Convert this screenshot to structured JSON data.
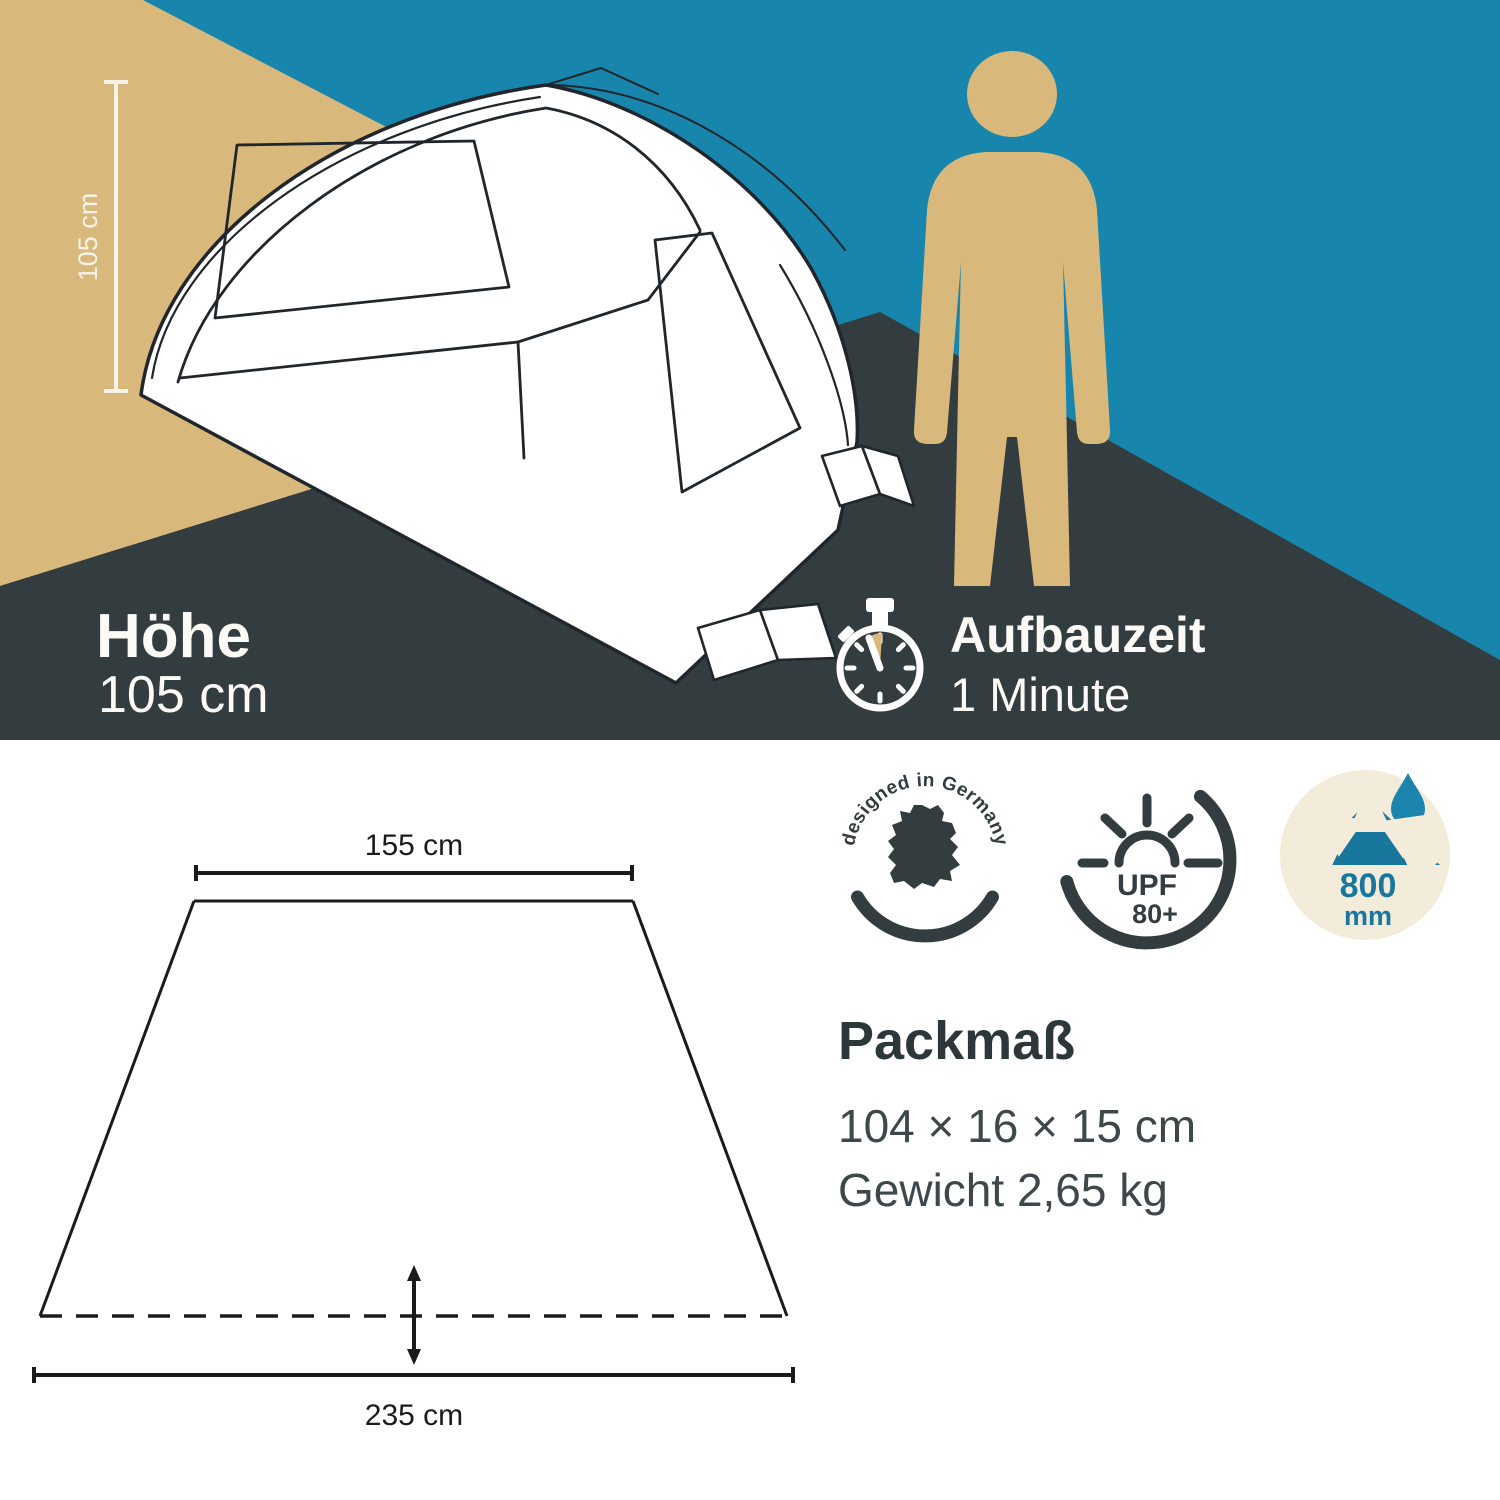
{
  "banner": {
    "height_measure_label": "105 cm",
    "height_title": "Höhe",
    "height_value": "105 cm",
    "setup_title": "Aufbauzeit",
    "setup_value": "1 Minute"
  },
  "floorplan": {
    "front_width_label": "155 cm",
    "back_width_label": "235 cm"
  },
  "badges": [
    {
      "id": "designed-in-germany",
      "arc_text": "designed in Germany"
    },
    {
      "id": "sun-protection",
      "arc_text": "sun protection",
      "value": "UPF",
      "suffix": "80+"
    },
    {
      "id": "water-column",
      "value": "800",
      "unit": "mm"
    }
  ],
  "pack": {
    "title": "Packmaß",
    "dimensions": "104 × 16 × 15 cm",
    "weight": "Gewicht 2,65 kg"
  },
  "colors": {
    "tan": "#d9b87c",
    "teal": "#1886ac",
    "dark": "#333c3e",
    "cream": "#f3ecda",
    "badge_ink": "#333c3e",
    "water_teal": "#19769c",
    "droplet_teal": "#1d84ad",
    "line_ink": "#1b1b19",
    "text_dark": "#2d3639",
    "text_body": "#3e474a"
  }
}
